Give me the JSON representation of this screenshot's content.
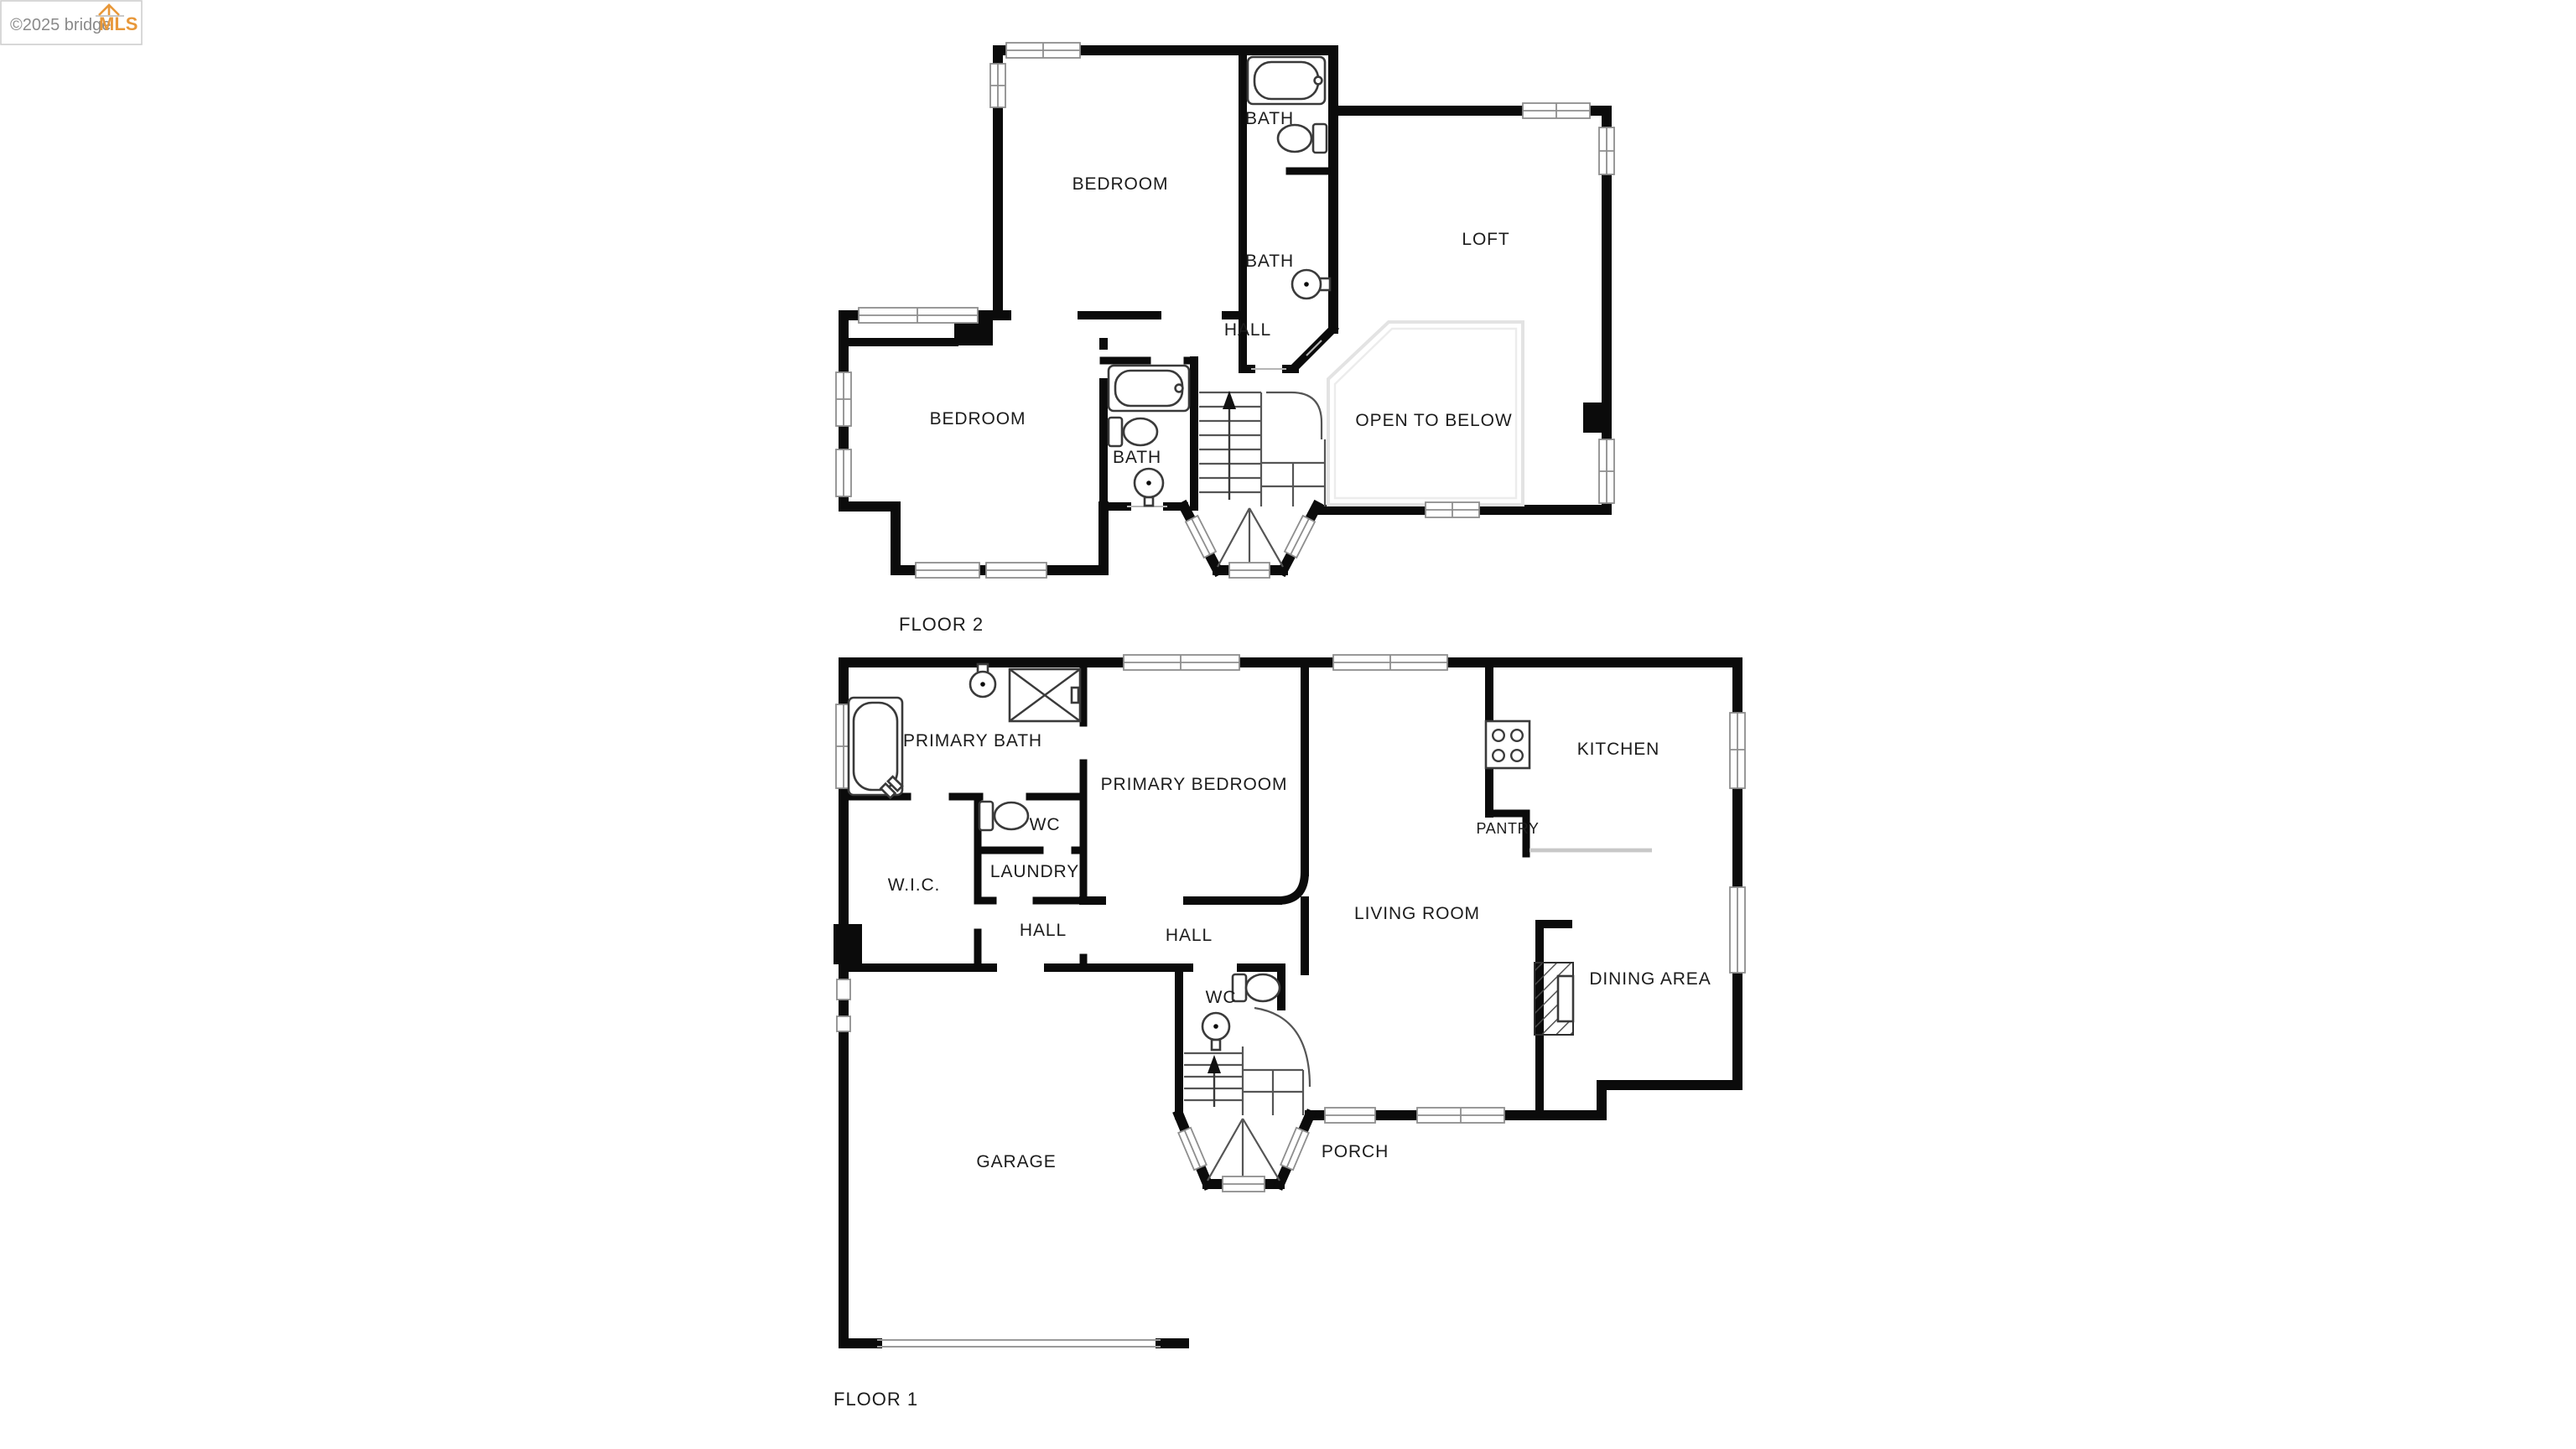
{
  "watermark": {
    "copyright_text": "©2025 bridge",
    "brand_text": "MLS"
  },
  "floor_2": {
    "title": "FLOOR 2",
    "rooms": {
      "bedroom_top": "BEDROOM",
      "bath_top": "BATH",
      "bath_middle": "BATH",
      "loft": "LOFT",
      "hall": "HALL",
      "bedroom_left": "BEDROOM",
      "bath_lower": "BATH",
      "open_to_below": "OPEN TO BELOW"
    }
  },
  "floor_1": {
    "title": "FLOOR 1",
    "rooms": {
      "primary_bath": "PRIMARY BATH",
      "primary_bedroom": "PRIMARY BEDROOM",
      "kitchen": "KITCHEN",
      "pantry": "PANTRY",
      "wc_upper": "WC",
      "wic": "W.I.C.",
      "laundry": "LAUNDRY",
      "hall_left": "HALL",
      "hall_right": "HALL",
      "living_room": "LIVING ROOM",
      "dining_area": "DINING AREA",
      "wc_lower": "WC",
      "garage": "GARAGE",
      "porch": "PORCH"
    }
  },
  "colors": {
    "wall": "#0b0b0b",
    "background": "#ffffff",
    "window_frame": "#8e8e8e",
    "brand_orange": "#e8983a",
    "label_text": "#1c1c1c"
  }
}
